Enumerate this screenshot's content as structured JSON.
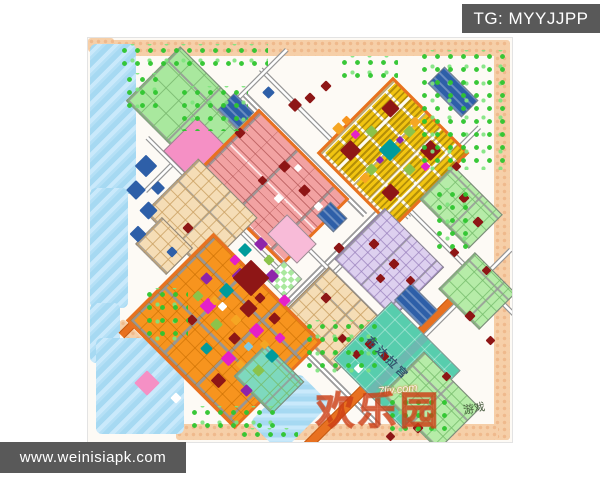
{
  "badges": {
    "telegram": {
      "label": "TG: MYYJJPP"
    },
    "website": {
      "label": "www.weinisiapk.com"
    }
  },
  "watermarks": {
    "palace": "布达拉宫",
    "site": "7liy.com",
    "brand": "欢乐园",
    "brand_suffix": "游戏"
  },
  "palette": {
    "badge_bg": "#595959",
    "badge_text": "#FFFFFF",
    "map_bg": "#FDFAF5",
    "border_peach": "#F6CFA8",
    "border_peach_dot": "#EFB98C",
    "water": "#A6D9F2",
    "road_gray": "#9A9A9A",
    "road_orange": "#E87120",
    "green_park": "#A9E89E",
    "tree_green": "#2EC52E",
    "salmon": "#F2A2A2",
    "wheat": "#F5DDB6",
    "orange": "#F7941E",
    "yellow": "#F1C411",
    "lavender": "#DDD0EF",
    "palegreen": "#B6ECA8",
    "teal_palace": "#57CDAD",
    "teal_green": "#7ED9BE",
    "pink": "#F590C5",
    "pink_light": "#F8BBD8",
    "blue": "#2E5FA8",
    "darkred": "#8E1616",
    "magenta": "#E520C8",
    "purple": "#8E24AA",
    "teal_small": "#009B9B",
    "lime": "#8BC34A",
    "gold": "#F5A623",
    "white": "#FFFFFF",
    "skyblue": "#7EC8E3",
    "brand_red": "#E6501E"
  },
  "map": {
    "bands": [
      [
        14,
        2,
        408,
        16
      ],
      [
        406,
        10,
        16,
        392
      ],
      [
        88,
        386,
        322,
        16
      ],
      [
        0,
        0,
        26,
        14
      ]
    ],
    "band_diag": [
      [
        22,
        300,
        60,
        12
      ]
    ],
    "water": [
      [
        2,
        6,
        46,
        150,
        0
      ],
      [
        2,
        150,
        38,
        120,
        0
      ],
      [
        2,
        265,
        30,
        60,
        0
      ],
      [
        8,
        300,
        88,
        96,
        0
      ],
      [
        180,
        340,
        44,
        70,
        45
      ]
    ],
    "roads": [
      [
        242,
        222,
        310,
        6,
        -45,
        "gray"
      ],
      [
        310,
        170,
        230,
        5,
        -45,
        "gray"
      ],
      [
        247,
        105,
        210,
        5,
        45,
        "gray"
      ],
      [
        203,
        300,
        250,
        6,
        45,
        "gray"
      ],
      [
        372,
        222,
        270,
        5,
        45,
        "gray"
      ],
      [
        296,
        330,
        250,
        8,
        -45,
        "orange"
      ],
      [
        128,
        82,
        200,
        5,
        -45,
        "gray"
      ],
      [
        130,
        170,
        200,
        5,
        45,
        "gray"
      ],
      [
        352,
        282,
        200,
        5,
        -45,
        "gray"
      ],
      [
        217,
        117,
        170,
        6,
        45,
        "gray"
      ],
      [
        260,
        250,
        180,
        5,
        45,
        "gray"
      ],
      [
        90,
        240,
        160,
        6,
        -45,
        "orange"
      ]
    ],
    "districts": [
      {
        "name": "park-northwest",
        "color": "green_park",
        "pattern": "grid-green",
        "cx": 100,
        "cy": 70,
        "w": 100,
        "h": 75
      },
      {
        "name": "pink-plaza",
        "color": "pink",
        "pattern": "solid",
        "cx": 108,
        "cy": 112,
        "w": 46,
        "h": 46
      },
      {
        "name": "landmark-blue-north",
        "color": "blue",
        "pattern": "stripes-blue",
        "cx": 147,
        "cy": 72,
        "w": 26,
        "h": 22
      },
      {
        "name": "salmon-district",
        "color": "salmon",
        "pattern": "rows-salmon",
        "cx": 180,
        "cy": 146,
        "w": 122,
        "h": 88,
        "ring": "#E87120"
      },
      {
        "name": "yellow-district",
        "color": "yellow",
        "pattern": "dots-yellow",
        "cx": 302,
        "cy": 112,
        "w": 102,
        "h": 102,
        "ring": "#E87120"
      },
      {
        "name": "wheat-west",
        "color": "wheat",
        "pattern": "grid-wheat",
        "cx": 112,
        "cy": 176,
        "w": 82,
        "h": 74
      },
      {
        "name": "wheat-dock",
        "color": "wheat",
        "pattern": "grid-wheat",
        "cx": 75,
        "cy": 207,
        "w": 42,
        "h": 36
      },
      {
        "name": "wheat-south",
        "color": "wheat",
        "pattern": "grid-wheat",
        "cx": 244,
        "cy": 280,
        "w": 78,
        "h": 66
      },
      {
        "name": "orange-district",
        "color": "orange",
        "pattern": "grid-orange",
        "cx": 133,
        "cy": 290,
        "w": 148,
        "h": 118,
        "ring": "#E87120"
      },
      {
        "name": "lavender-district",
        "color": "lavender",
        "pattern": "grid-lavender",
        "cx": 300,
        "cy": 224,
        "w": 82,
        "h": 70
      },
      {
        "name": "pink-block",
        "color": "pink_light",
        "pattern": "solid",
        "cx": 203,
        "cy": 200,
        "w": 40,
        "h": 26
      },
      {
        "name": "potala-palace",
        "color": "teal_palace",
        "pattern": "grid-teal",
        "cx": 308,
        "cy": 326,
        "w": 96,
        "h": 80
      },
      {
        "name": "palegreen-east-1",
        "color": "palegreen",
        "pattern": "grid-palegreen",
        "cx": 372,
        "cy": 168,
        "w": 68,
        "h": 46
      },
      {
        "name": "palegreen-east-2",
        "color": "palegreen",
        "pattern": "grid-palegreen",
        "cx": 388,
        "cy": 252,
        "w": 56,
        "h": 50
      },
      {
        "name": "palegreen-south",
        "color": "palegreen",
        "pattern": "grid-palegreen",
        "cx": 342,
        "cy": 362,
        "w": 78,
        "h": 58
      },
      {
        "name": "tealgreen-south",
        "color": "teal_green",
        "pattern": "grid-palegreen",
        "cx": 180,
        "cy": 340,
        "w": 52,
        "h": 44
      },
      {
        "name": "landmark-blue-northeast",
        "color": "blue",
        "pattern": "stripes-blue",
        "cx": 364,
        "cy": 53,
        "w": 46,
        "h": 22
      },
      {
        "name": "landmark-blue-center",
        "color": "blue",
        "pattern": "stripes-blue",
        "cx": 243,
        "cy": 178,
        "w": 22,
        "h": 18
      },
      {
        "name": "landmark-blue-southeast",
        "color": "blue",
        "pattern": "stripes-blue",
        "cx": 327,
        "cy": 266,
        "w": 36,
        "h": 22
      },
      {
        "name": "park-checker",
        "color": "green_park",
        "pattern": "checker",
        "cx": 195,
        "cy": 240,
        "w": 24,
        "h": 24
      }
    ],
    "trees": [
      [
        30,
        6,
        150,
        22
      ],
      [
        90,
        48,
        70,
        45
      ],
      [
        330,
        12,
        88,
        120
      ],
      [
        345,
        150,
        42,
        62
      ],
      [
        55,
        250,
        45,
        55
      ],
      [
        100,
        368,
        90,
        30
      ],
      [
        215,
        282,
        75,
        55
      ],
      [
        250,
        18,
        60,
        28
      ],
      [
        298,
        358,
        64,
        42
      ],
      [
        35,
        35,
        40,
        35
      ],
      [
        150,
        390,
        60,
        18
      ]
    ],
    "accents": [
      [
        262,
        112,
        15,
        "darkred"
      ],
      [
        342,
        112,
        15,
        "darkred"
      ],
      [
        302,
        70,
        13,
        "darkred"
      ],
      [
        302,
        154,
        13,
        "darkred"
      ],
      [
        302,
        112,
        16,
        "teal_small"
      ],
      [
        283,
        93,
        9,
        "lime"
      ],
      [
        321,
        131,
        9,
        "lime"
      ],
      [
        283,
        131,
        9,
        "lime"
      ],
      [
        321,
        93,
        9,
        "lime"
      ],
      [
        267,
        96,
        7,
        "magenta"
      ],
      [
        337,
        128,
        7,
        "magenta"
      ],
      [
        292,
        122,
        6,
        "purple"
      ],
      [
        312,
        102,
        6,
        "purple"
      ],
      [
        327,
        84,
        8,
        "gold"
      ],
      [
        277,
        140,
        8,
        "gold"
      ],
      [
        207,
        67,
        10,
        "darkred"
      ],
      [
        222,
        60,
        8,
        "darkred"
      ],
      [
        152,
        95,
        8,
        "darkred"
      ],
      [
        180,
        54,
        9,
        "blue"
      ],
      [
        238,
        48,
        8,
        "darkred"
      ],
      [
        196,
        128,
        9,
        "darkred"
      ],
      [
        216,
        152,
        9,
        "darkred"
      ],
      [
        174,
        142,
        7,
        "darkred"
      ],
      [
        230,
        168,
        7,
        "white"
      ],
      [
        190,
        160,
        7,
        "white"
      ],
      [
        210,
        130,
        6,
        "white"
      ],
      [
        120,
        268,
        12,
        "magenta"
      ],
      [
        168,
        292,
        11,
        "magenta"
      ],
      [
        140,
        320,
        11,
        "magenta"
      ],
      [
        196,
        262,
        9,
        "magenta"
      ],
      [
        138,
        252,
        11,
        "teal_small"
      ],
      [
        118,
        310,
        9,
        "teal_small"
      ],
      [
        184,
        318,
        10,
        "teal_small"
      ],
      [
        152,
        238,
        12,
        "purple"
      ],
      [
        184,
        238,
        10,
        "purple"
      ],
      [
        118,
        240,
        9,
        "purple"
      ],
      [
        158,
        352,
        9,
        "purple"
      ],
      [
        160,
        270,
        13,
        "darkred"
      ],
      [
        130,
        342,
        11,
        "darkred"
      ],
      [
        186,
        280,
        9,
        "darkred"
      ],
      [
        146,
        300,
        9,
        "darkred"
      ],
      [
        172,
        260,
        8,
        "darkred"
      ],
      [
        104,
        282,
        8,
        "darkred"
      ],
      [
        192,
        300,
        8,
        "magenta"
      ],
      [
        128,
        286,
        9,
        "lime"
      ],
      [
        170,
        332,
        9,
        "lime"
      ],
      [
        110,
        258,
        8,
        "lime"
      ],
      [
        148,
        282,
        8,
        "gold"
      ],
      [
        126,
        262,
        7,
        "gold"
      ],
      [
        176,
        306,
        7,
        "gold"
      ],
      [
        152,
        326,
        7,
        "gold"
      ],
      [
        134,
        268,
        7,
        "white"
      ],
      [
        160,
        308,
        7,
        "skyblue"
      ],
      [
        163,
        240,
        26,
        "darkred"
      ],
      [
        157,
        212,
        10,
        "teal_small"
      ],
      [
        173,
        206,
        10,
        "purple"
      ],
      [
        147,
        222,
        8,
        "magenta"
      ],
      [
        181,
        222,
        8,
        "lime"
      ],
      [
        286,
        206,
        8,
        "darkred"
      ],
      [
        306,
        226,
        8,
        "darkred"
      ],
      [
        322,
        242,
        7,
        "darkred"
      ],
      [
        292,
        240,
        7,
        "darkred"
      ],
      [
        376,
        160,
        8,
        "darkred"
      ],
      [
        390,
        184,
        8,
        "darkred"
      ],
      [
        366,
        214,
        7,
        "darkred"
      ],
      [
        398,
        232,
        7,
        "darkred"
      ],
      [
        382,
        278,
        8,
        "darkred"
      ],
      [
        402,
        302,
        7,
        "darkred"
      ],
      [
        358,
        338,
        7,
        "darkred"
      ],
      [
        330,
        390,
        8,
        "darkred"
      ],
      [
        302,
        398,
        7,
        "darkred"
      ],
      [
        368,
        128,
        7,
        "darkred"
      ],
      [
        282,
        306,
        8,
        "darkred"
      ],
      [
        296,
        318,
        7,
        "darkred"
      ],
      [
        270,
        330,
        7,
        "white"
      ],
      [
        100,
        190,
        8,
        "darkred"
      ],
      [
        84,
        214,
        8,
        "blue"
      ],
      [
        254,
        300,
        7,
        "darkred"
      ],
      [
        268,
        316,
        7,
        "darkred"
      ],
      [
        238,
        260,
        8,
        "darkred"
      ],
      [
        251,
        210,
        8,
        "darkred"
      ],
      [
        58,
        128,
        16,
        "blue"
      ],
      [
        48,
        152,
        14,
        "blue"
      ],
      [
        60,
        172,
        13,
        "blue"
      ],
      [
        50,
        196,
        12,
        "blue"
      ],
      [
        70,
        150,
        10,
        "blue"
      ],
      [
        59,
        345,
        18,
        "pink"
      ],
      [
        88,
        360,
        8,
        "white"
      ],
      [
        250,
        90,
        9,
        "gold"
      ],
      [
        258,
        82,
        7,
        "orange"
      ]
    ]
  }
}
